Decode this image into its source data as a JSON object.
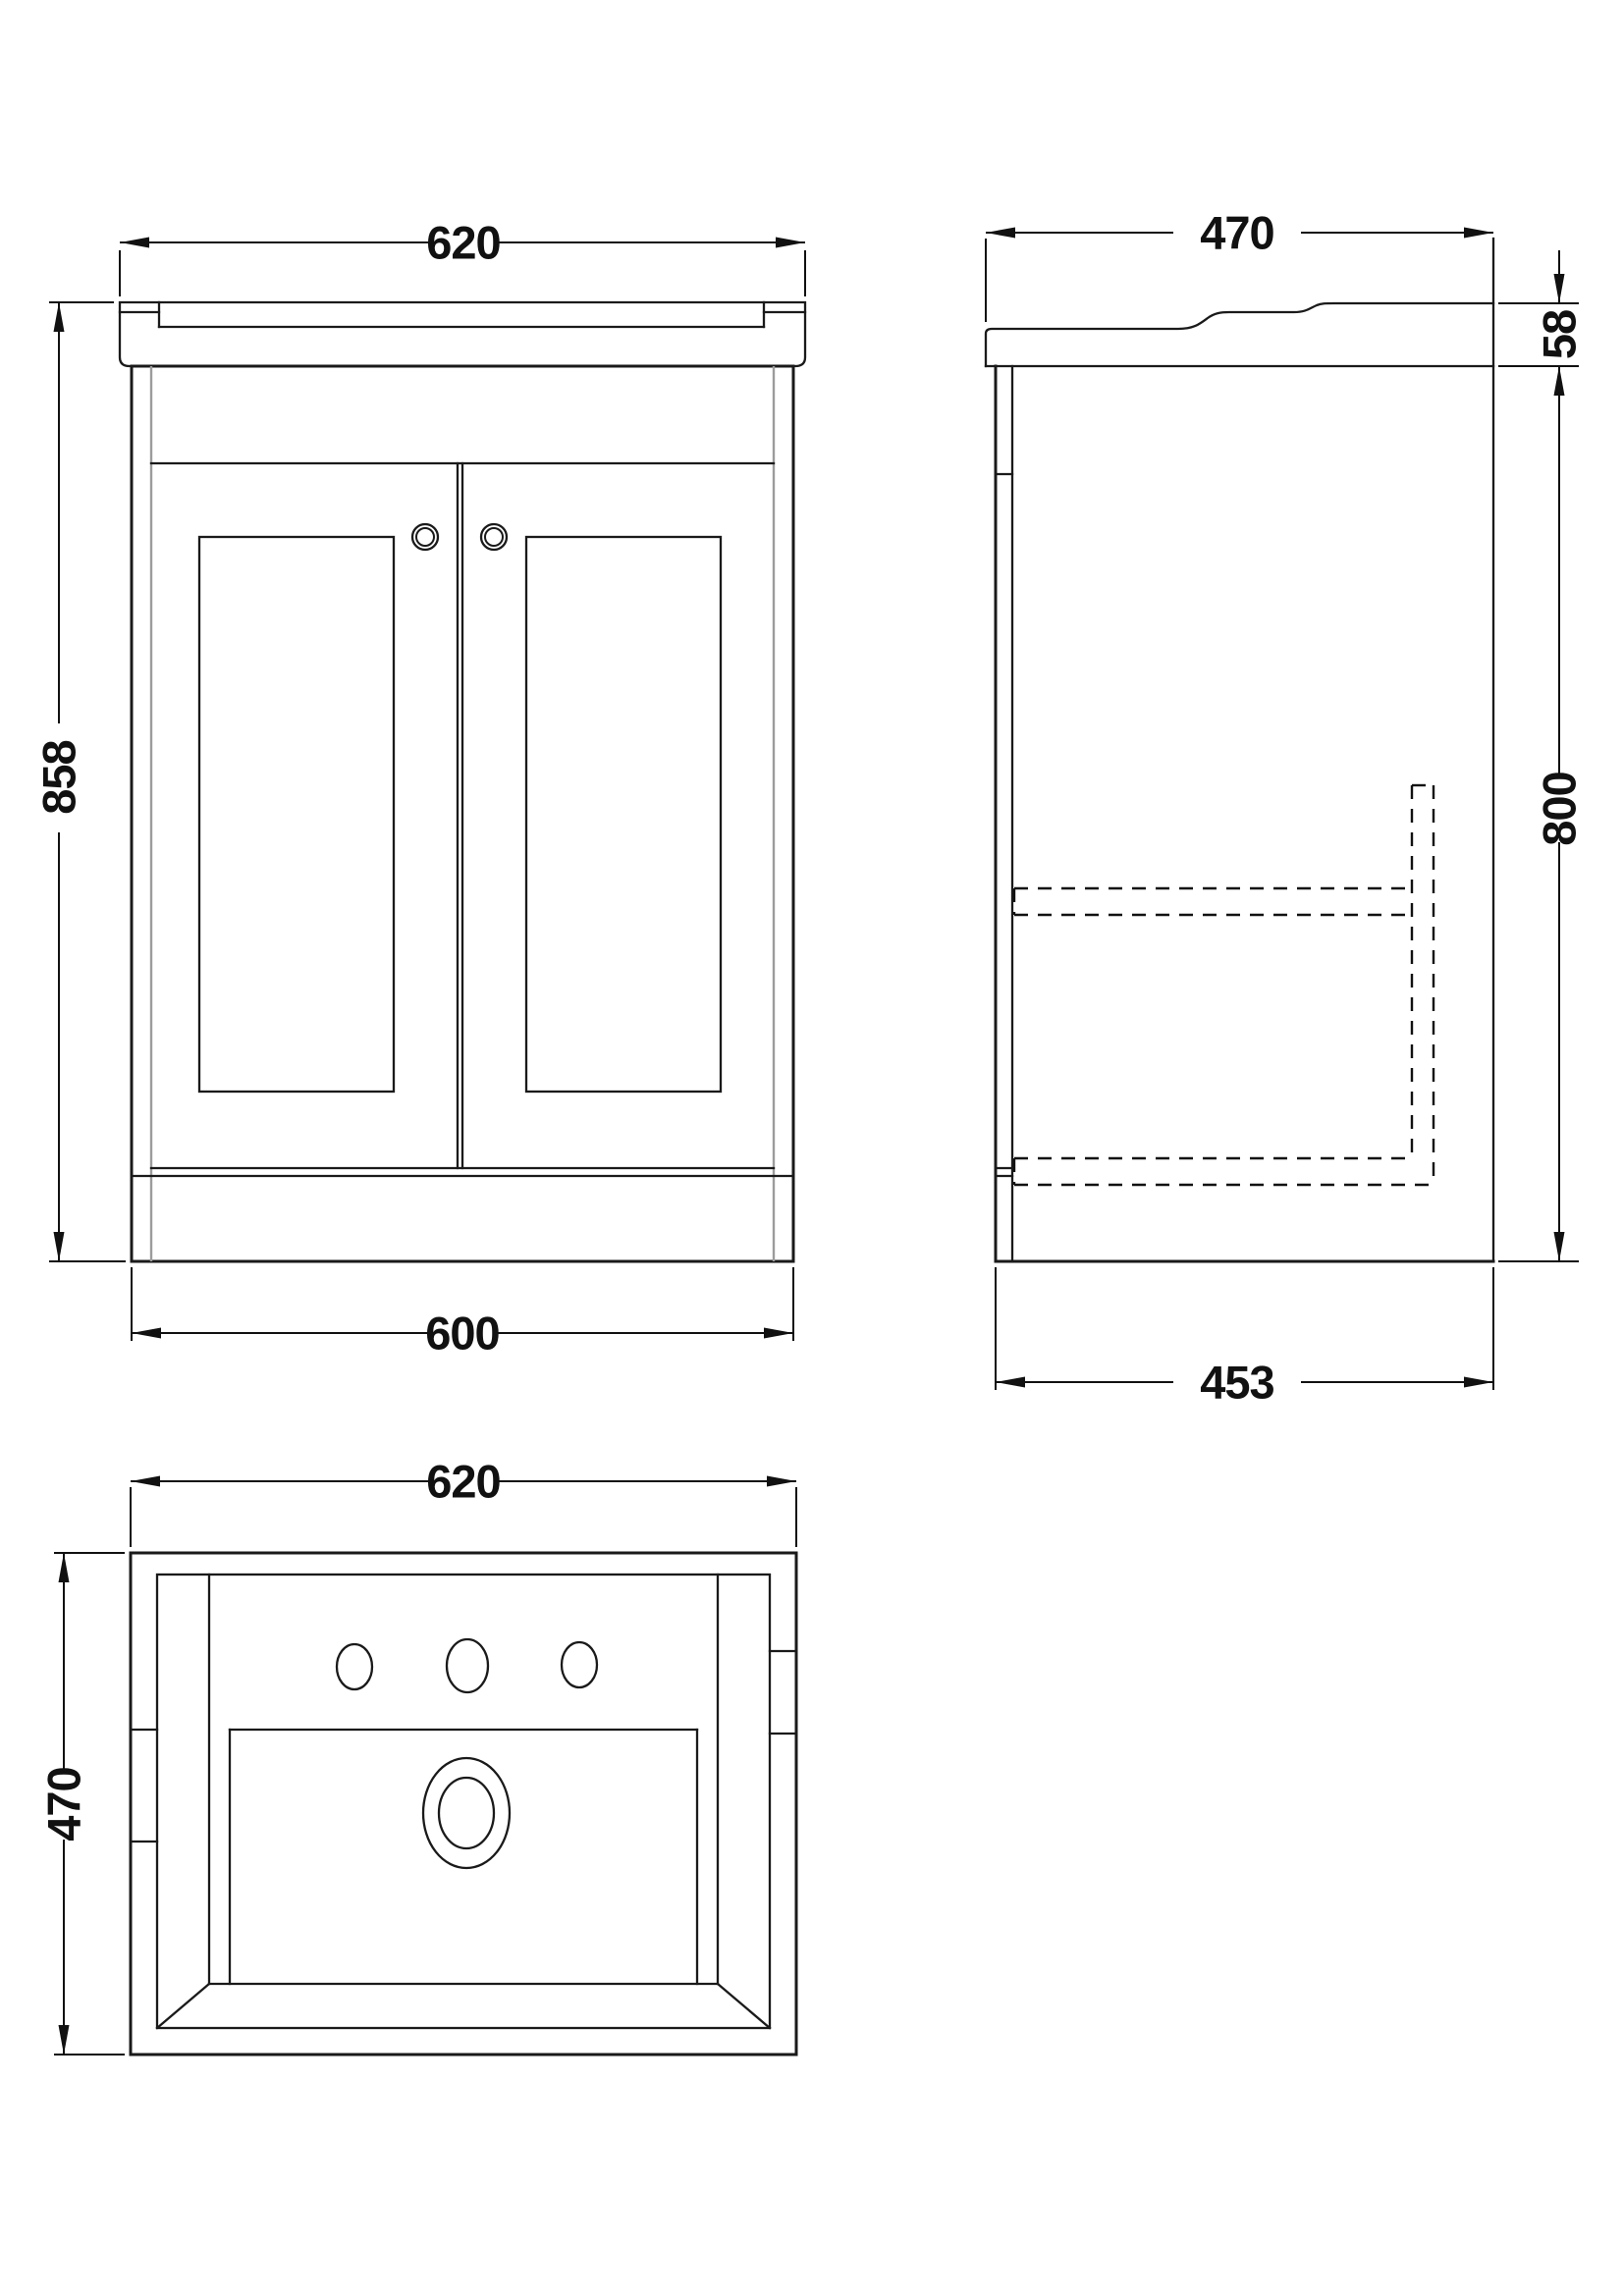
{
  "drawing": {
    "type": "technical-dimension-drawing",
    "subject": "vanity-unit-with-basin",
    "views": {
      "front": {
        "name": "front-view",
        "dims": {
          "width_top": "620",
          "height": "858",
          "width_bottom": "600"
        }
      },
      "side": {
        "name": "side-view",
        "dims": {
          "depth_top": "470",
          "basin_height": "58",
          "body_height": "800",
          "depth_bottom": "453"
        }
      },
      "plan": {
        "name": "plan-view",
        "dims": {
          "width": "620",
          "depth": "470"
        }
      }
    },
    "style": {
      "line_color": "#1a1a1a",
      "accent_gray": "#9c9c9c",
      "background": "#ffffff"
    }
  }
}
